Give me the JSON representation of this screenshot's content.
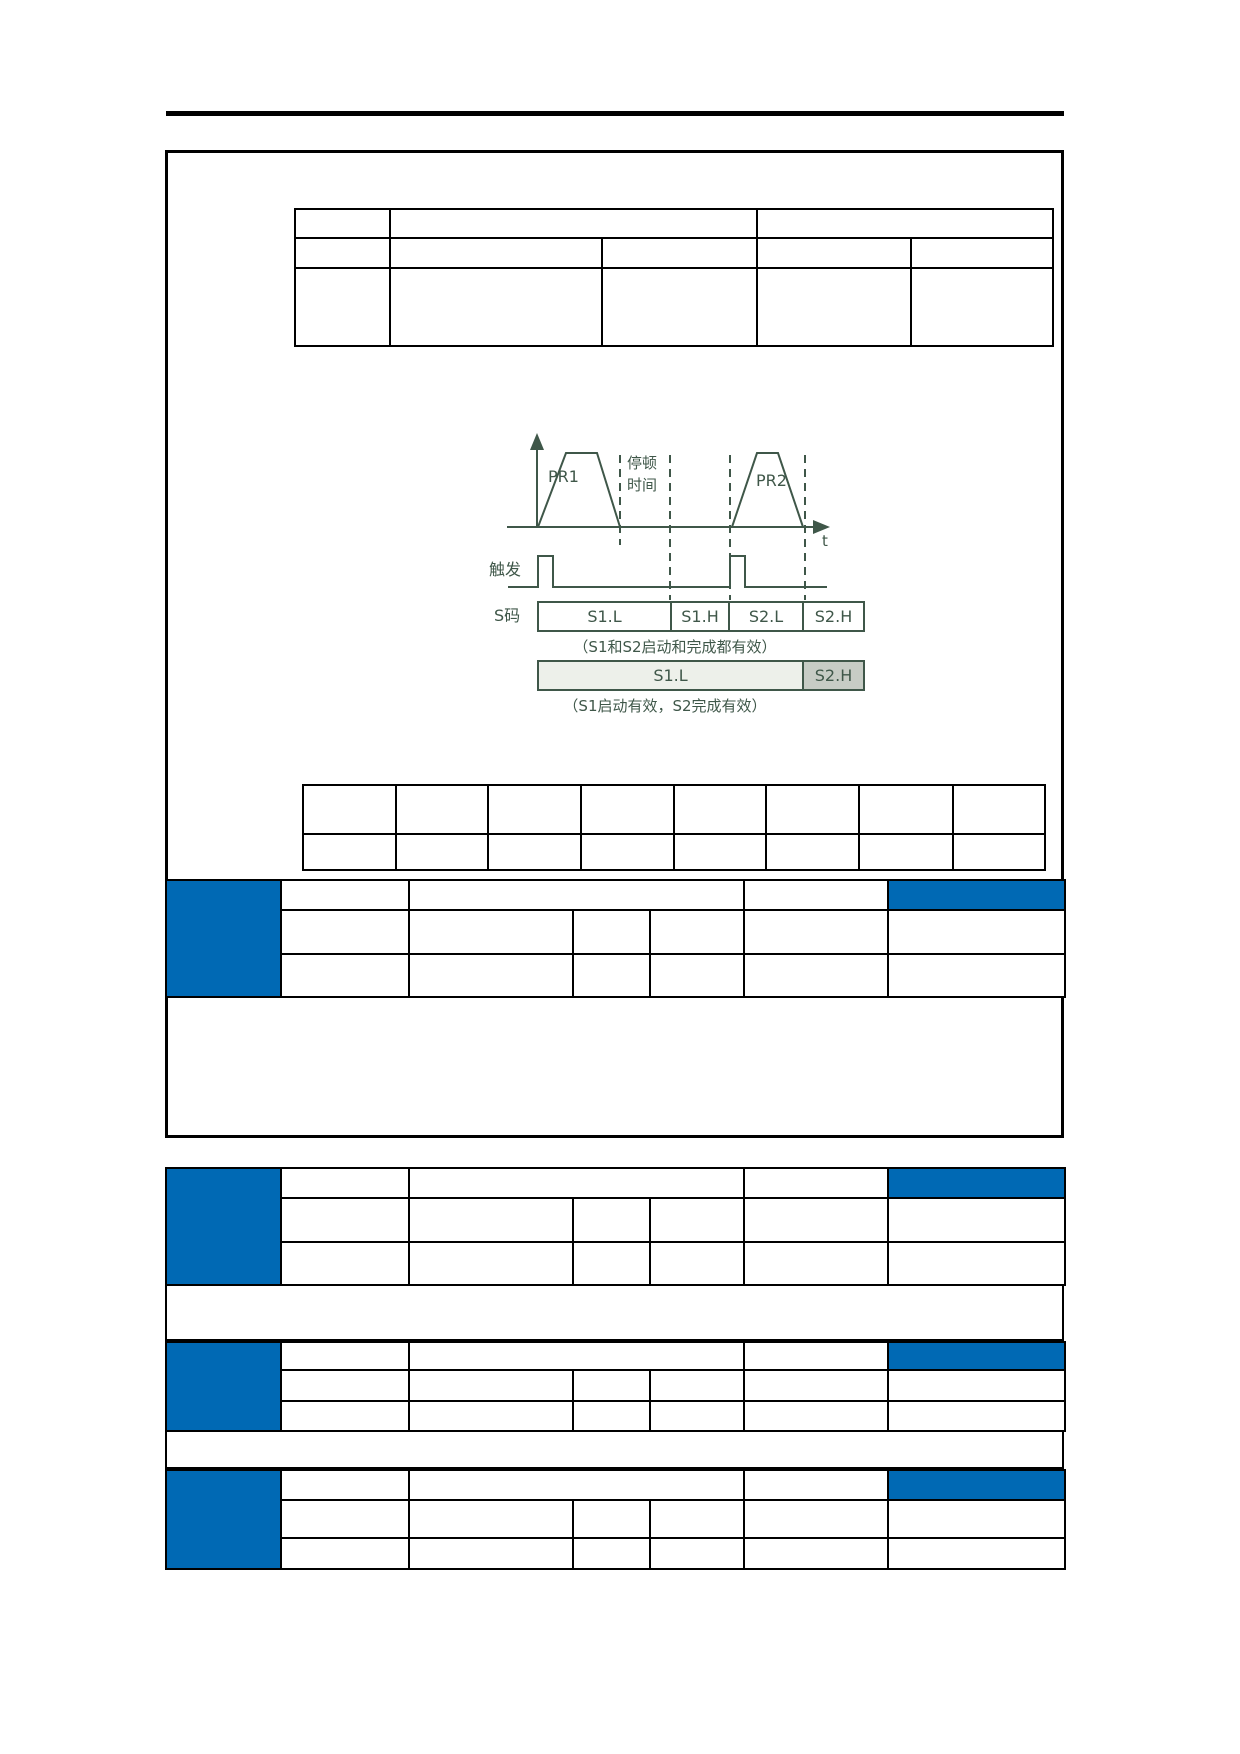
{
  "colors": {
    "accent_blue": "#0069B4",
    "diagram_green": "#3F5749",
    "bar_s1l_fill": "#EDF0EA",
    "bar_s2h_fill": "#C7CCC5"
  },
  "diagram": {
    "pr1_label": "PR1",
    "pr2_label": "PR2",
    "pause_line1": "停顿",
    "pause_line2": "时间",
    "t_axis_label": "t",
    "trigger_label": "触发",
    "s_code_label": "S码",
    "bar1_cells": [
      "S1.L",
      "S1.H",
      "S2.L",
      "S2.H"
    ],
    "bar1_caption": "（S1和S2启动和完成都有效）",
    "bar2_cells": [
      "S1.L",
      "S2.H"
    ],
    "bar2_caption": "（S1启动有效，S2完成有效）"
  }
}
